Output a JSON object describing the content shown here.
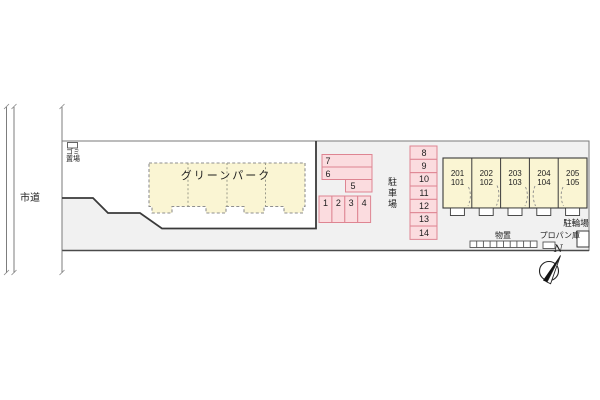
{
  "site": {
    "road_label": "市道",
    "garbage_line1": "ゴミ",
    "garbage_line2": "置場"
  },
  "main_building": {
    "name": "グリーンパーク"
  },
  "parking": {
    "label": "駐車場",
    "spaces": [
      "1",
      "2",
      "3",
      "4",
      "5",
      "6",
      "7",
      "8",
      "9",
      "10",
      "11",
      "12",
      "13",
      "14"
    ]
  },
  "row_house": {
    "units": [
      {
        "upper": "201",
        "lower": "101"
      },
      {
        "upper": "202",
        "lower": "102"
      },
      {
        "upper": "203",
        "lower": "103"
      },
      {
        "upper": "204",
        "lower": "104"
      },
      {
        "upper": "205",
        "lower": "105"
      }
    ]
  },
  "facilities": {
    "storage": "物置",
    "propane": "プロパン庫",
    "bicycle": "駐輪場"
  },
  "compass": {
    "label": "N"
  },
  "colors": {
    "ground_fill": "#f1f1f1",
    "parcel_fill": "#ffffff",
    "building_fill": "#faf5d3",
    "parking_fill": "#fbdcdf",
    "parking_border": "#de8592",
    "dark_line": "#3a3a3a",
    "boundary_line": "#7a7a7a"
  }
}
